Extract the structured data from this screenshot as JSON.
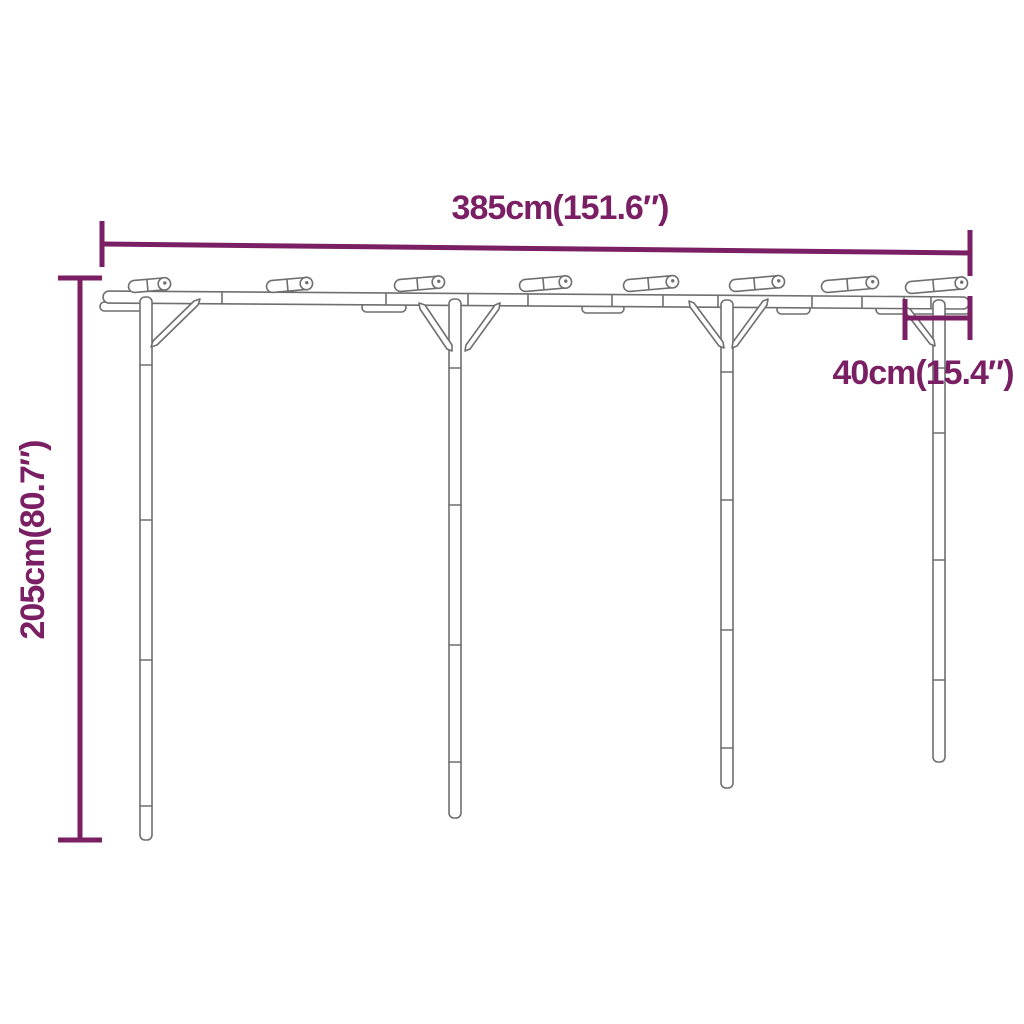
{
  "page": {
    "background_color": "#ffffff"
  },
  "diagram": {
    "accent_color": "#7a1f63",
    "structure_line_color": "#6f6f6f",
    "annotations": {
      "width": {
        "label": "385cm(151.6″)",
        "value_cm": 385,
        "value_inches": 151.6,
        "orientation": "horizontal",
        "position": "top"
      },
      "height": {
        "label": "205cm(80.7″)",
        "value_cm": 205,
        "value_inches": 80.7,
        "orientation": "vertical",
        "position": "left"
      },
      "depth": {
        "label": "40cm(15.4″)",
        "value_cm": 40,
        "value_inches": 15.4,
        "orientation": "horizontal",
        "position": "right"
      }
    },
    "structure": {
      "posts": 4,
      "rafters": 8,
      "braces": 6
    }
  }
}
